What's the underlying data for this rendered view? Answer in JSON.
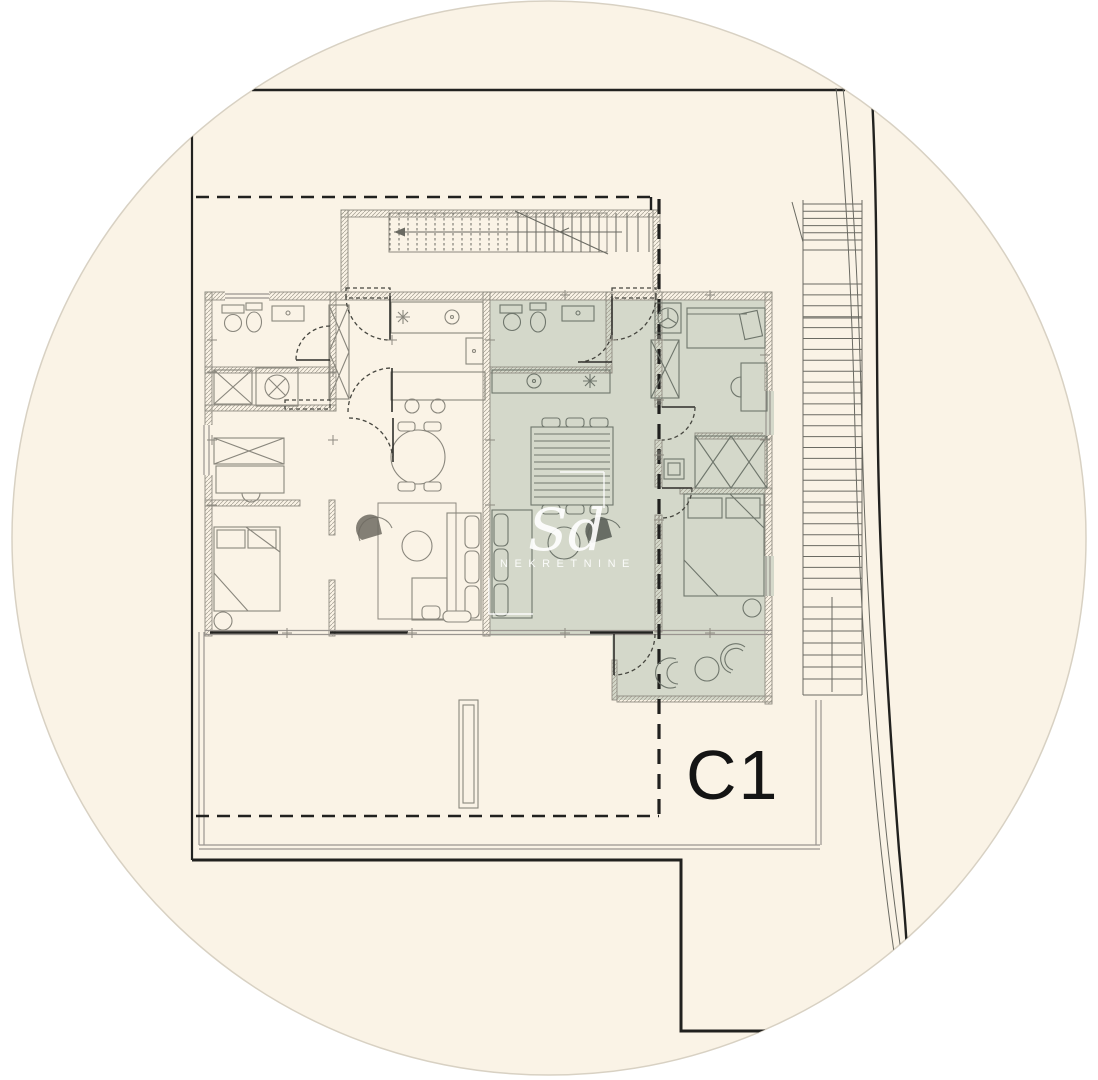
{
  "drawing": {
    "type": "architectural-floor-plan",
    "unit_label": "C1",
    "watermark": {
      "script": "Sd",
      "caps": "NEKRETNINE"
    }
  },
  "colors": {
    "bg-outside": "#ffffff",
    "bg-paper": "#faf3e6",
    "unit-fill": "#d4d8ca",
    "line-dark": "#21211f",
    "line-mid": "#8d8a80",
    "furn": "#8a877d",
    "furn-unit": "#6f766c",
    "label": "#141414",
    "wm": "#ffffff"
  }
}
